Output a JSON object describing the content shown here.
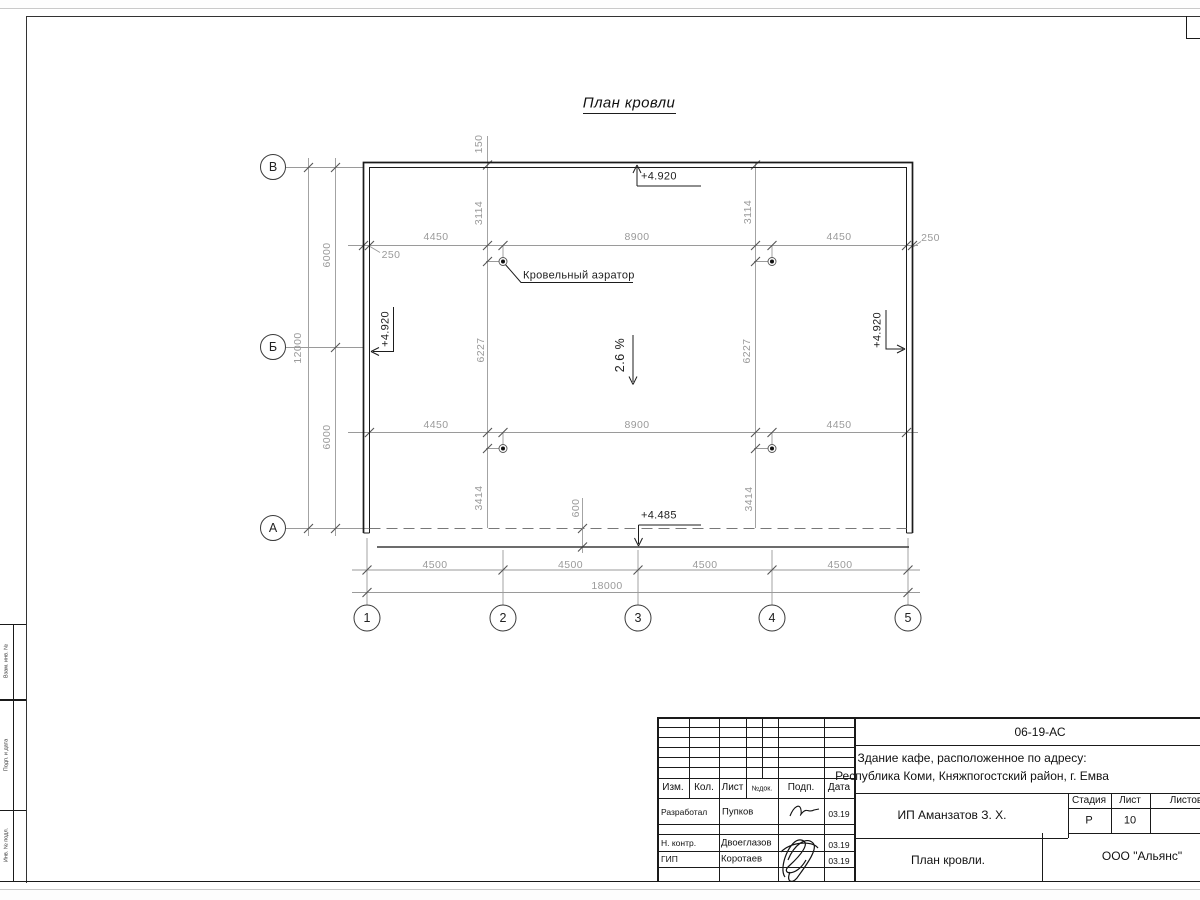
{
  "drawing": {
    "title": "План кровли",
    "slope": "2.6 %",
    "aerator_label": "Кровельный аэратор",
    "elev_top": "+4.920",
    "elev_left": "+4.920",
    "elev_right": "+4.920",
    "elev_eaves": "+4.485",
    "axes_rows": [
      "В",
      "Б",
      "А"
    ],
    "axes_cols": [
      "1",
      "2",
      "3",
      "4",
      "5"
    ],
    "dims": {
      "top_row": [
        "4450",
        "8900",
        "4450"
      ],
      "mid_row": [
        "4450",
        "8900",
        "4450"
      ],
      "bottom_row": [
        "4500",
        "4500",
        "4500",
        "4500"
      ],
      "overall_bottom": "18000",
      "overall_left": "12000",
      "left_segments": [
        "6000",
        "6000"
      ],
      "v_upper": [
        "3114",
        "3114"
      ],
      "v_mid": [
        "6227",
        "6227"
      ],
      "v_lower": [
        "3414",
        "3414"
      ],
      "parapet": "150",
      "edge_left": "250",
      "edge_right": "250",
      "eaves_offset": "600"
    }
  },
  "title_block": {
    "doc_code": "06-19-АС",
    "project_line1": "Здание кафе, расположенное по адресу:",
    "project_line2": "Республика Коми, Княжпогостский район, г. Емва",
    "client": "ИП Аманзатов З. Х.",
    "sheet_title": "План кровли.",
    "company": "ООО \"Альянс\"",
    "columns": {
      "izm": "Изм.",
      "kol": "Кол.",
      "list": "Лист",
      "doc": "№док.",
      "podp": "Подп.",
      "data": "Дата"
    },
    "stage_header": {
      "stage": "Стадия",
      "sheet": "Лист",
      "sheets": "Листов"
    },
    "stage_value": "Р",
    "sheet_number": "10",
    "rows": [
      {
        "role": "Разработал",
        "name": "Пупков",
        "date": "03.19"
      },
      {
        "role": "Н. контр.",
        "name": "Двоеглазов",
        "date": "03.19"
      },
      {
        "role": "ГИП",
        "name": "Коротаев",
        "date": "03.19"
      }
    ]
  },
  "side_stamp": {
    "labels": [
      "Взам. инв. №",
      "Подп. и дата",
      "Инв. № подл."
    ]
  }
}
